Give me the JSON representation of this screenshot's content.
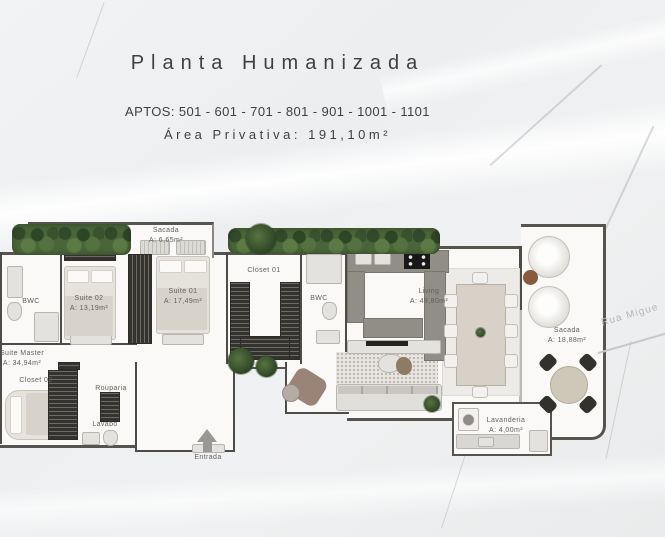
{
  "header": {
    "title": "Planta Humanizada",
    "apartments": "APTOS: 501 - 601 - 701 - 801 - 901 - 1001 - 1101",
    "private_area": "Área Privativa: 191,10m²"
  },
  "rooms": {
    "sacada_top": {
      "name": "Sacada",
      "area": "A: 6,65m²"
    },
    "bwc_left": {
      "name": "BWC"
    },
    "suite02": {
      "name": "Suite 02",
      "area": "A: 13,19m²"
    },
    "suite01": {
      "name": "Suite 01",
      "area": "A: 17,49m²"
    },
    "closet01": {
      "name": "Closet 01"
    },
    "bwc_mid": {
      "name": "BWC"
    },
    "living": {
      "name": "Living",
      "area": "A: 49,80m²"
    },
    "sacada_right": {
      "name": "Sacada",
      "area": "A: 18,88m²"
    },
    "suite_master": {
      "name": "Suite Master",
      "area": "A: 34,94m²"
    },
    "closet02": {
      "name": "Closet 02"
    },
    "rouparia": {
      "name": "Rouparia"
    },
    "lavabo": {
      "name": "Lavabo"
    },
    "lavanderia": {
      "name": "Lavanderia",
      "area": "A: 4,00m²"
    },
    "entrada": {
      "name": "Entrada"
    }
  },
  "street": {
    "label": "Rua Migue"
  },
  "colors": {
    "wall": "#4e4c48",
    "hedge_green": "#4a6539",
    "counter_gray": "#918d87",
    "cooktop_black": "#181818",
    "wood_accent": "#8a5a3c"
  }
}
